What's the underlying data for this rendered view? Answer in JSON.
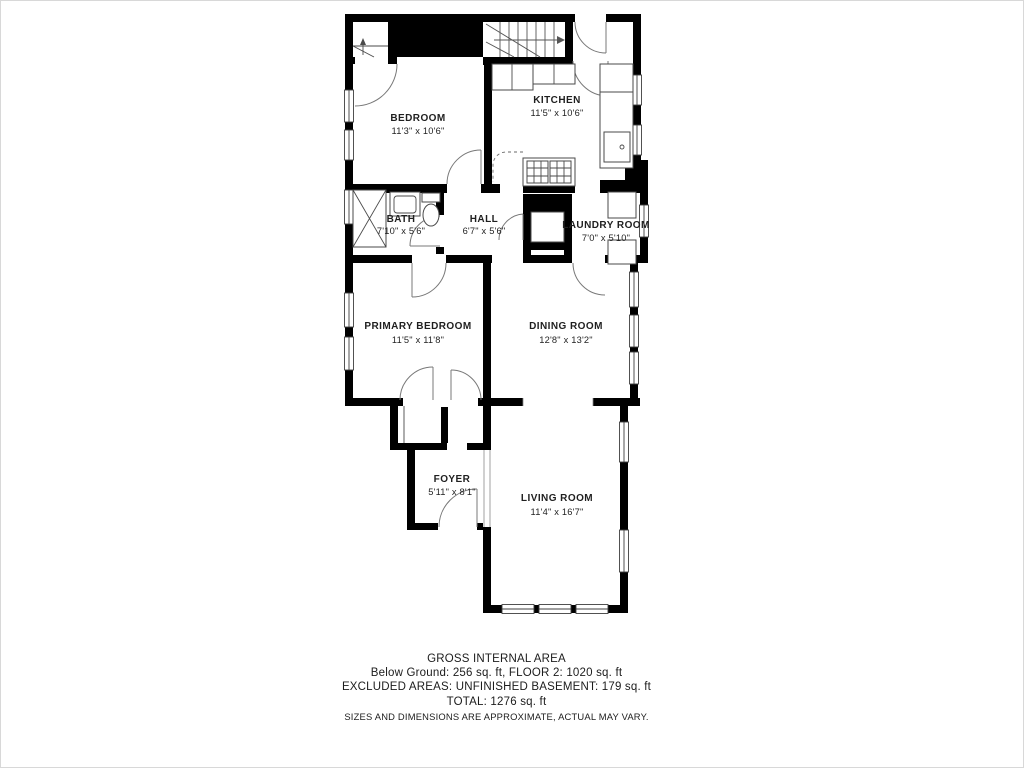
{
  "floor_plan": {
    "rooms": [
      {
        "id": "bedroom",
        "name": "BEDROOM",
        "dims": "11'3\" x 10'6\""
      },
      {
        "id": "kitchen",
        "name": "KITCHEN",
        "dims": "11'5\" x 10'6\""
      },
      {
        "id": "bath",
        "name": "BATH",
        "dims": "7'10\" x 5'6\""
      },
      {
        "id": "hall",
        "name": "HALL",
        "dims": "6'7\" x 5'6\""
      },
      {
        "id": "laundry-room",
        "name": "LAUNDRY ROOM",
        "dims": "7'0\" x 5'10\""
      },
      {
        "id": "primary-bedroom",
        "name": "PRIMARY BEDROOM",
        "dims": "11'5\" x 11'8\""
      },
      {
        "id": "dining-room",
        "name": "DINING ROOM",
        "dims": "12'8\" x 13'2\""
      },
      {
        "id": "foyer",
        "name": "FOYER",
        "dims": "5'11\" x 8'1\""
      },
      {
        "id": "living-room",
        "name": "LIVING ROOM",
        "dims": "11'4\" x 16'7\""
      }
    ],
    "footer": {
      "title": "GROSS INTERNAL AREA",
      "line1": "Below Ground: 256 sq. ft, FLOOR 2: 1020 sq. ft",
      "line2": "EXCLUDED AREAS: UNFINISHED BASEMENT: 179 sq. ft",
      "line3": "TOTAL: 1276 sq. ft",
      "disclaimer": "SIZES AND DIMENSIONS ARE APPROXIMATE, ACTUAL MAY VARY."
    },
    "colors": {
      "wall": "#000000",
      "fixture_line": "#4a4a4a",
      "text": "#1f1f1f",
      "background": "#ffffff"
    }
  }
}
